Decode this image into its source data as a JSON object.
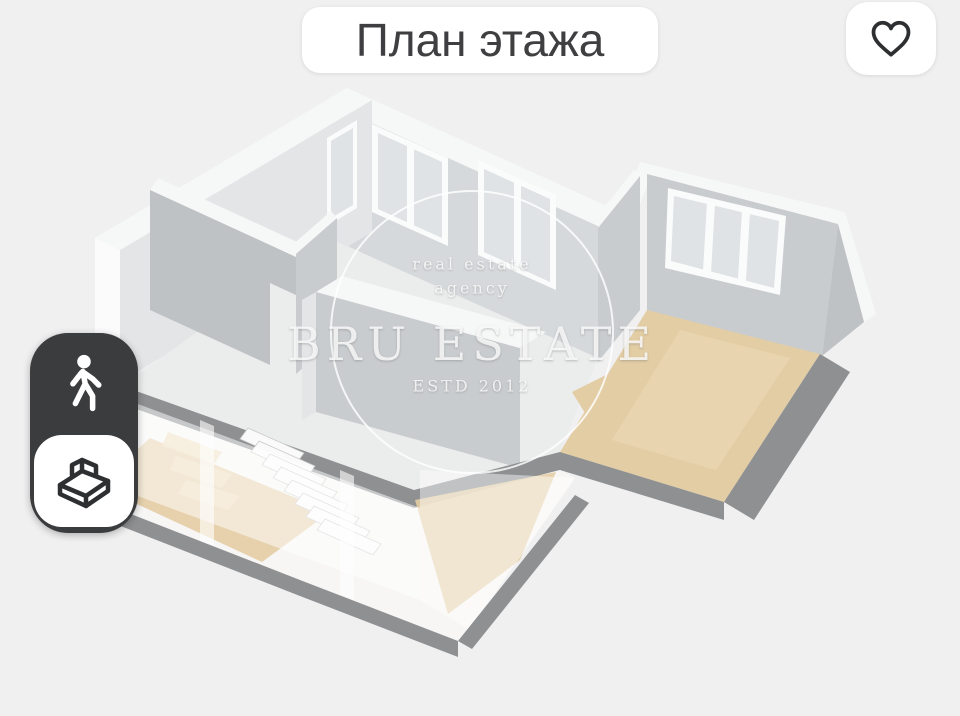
{
  "page": {
    "title_chip": "План этажа"
  },
  "theme": {
    "bg": "#f0f0f1",
    "chip_bg": "#ffffff",
    "chip_text": "#3f3f41",
    "icon_dark": "#2e2f31",
    "toggle_bg": "#3b3c3e",
    "toggle_active_bg": "#ffffff",
    "wall_light": "#e3e5e7",
    "wall_mid": "#d6d9db",
    "wall_face": "#c9cccf",
    "wall_dark": "#bfc2c5",
    "wall_top": "#f6f7f7",
    "floor_light": "#ebecec",
    "wood": "#e3cda4",
    "wood_light": "#ecdcba",
    "slab": "#8f9092",
    "glass": "#dfe3e6",
    "watermark": "rgba(255,255,255,0.8)"
  },
  "watermark": {
    "top_line1": "real estate",
    "top_line2": "agency",
    "brand": "BRU ESTATE",
    "bottom_line": "ESTD 2012"
  },
  "favorite": {
    "icon": "heart-outline-icon",
    "active": false
  },
  "mode_toggle": {
    "options": [
      {
        "id": "walk",
        "icon": "walking-person-icon",
        "active": false
      },
      {
        "id": "plan3d",
        "icon": "isometric-room-icon",
        "active": true
      }
    ]
  },
  "floorplan": {
    "type": "3d-render",
    "visible_floors": 2
  }
}
